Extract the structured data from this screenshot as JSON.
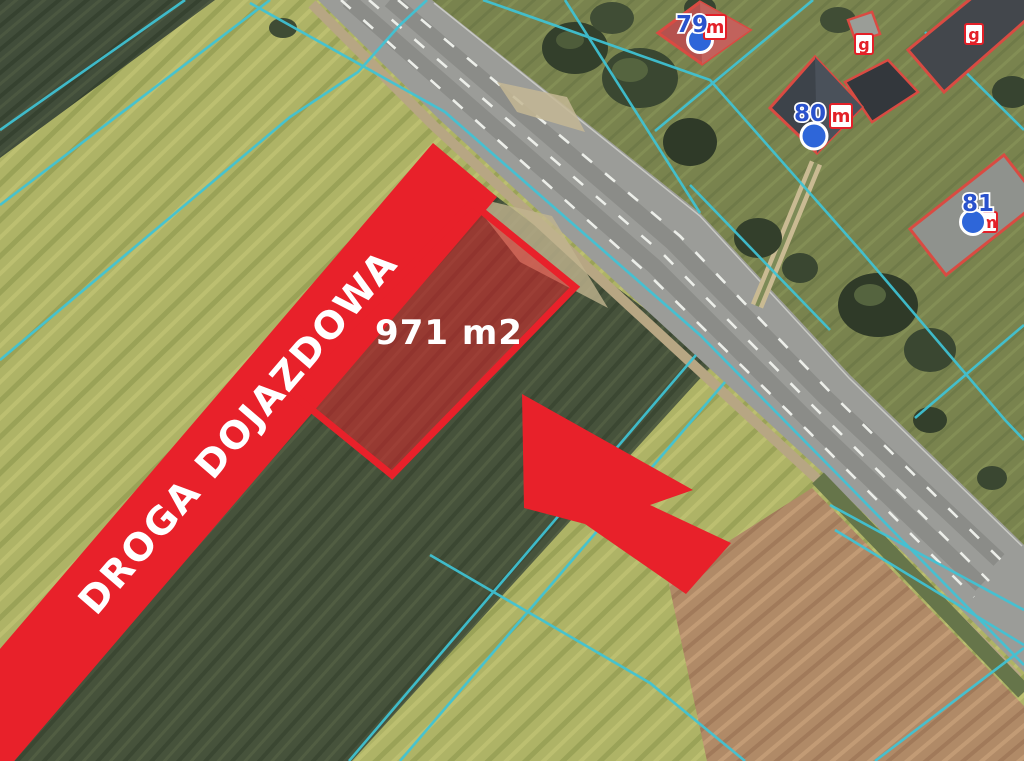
{
  "map": {
    "plot_area_label": "971 m2",
    "access_road_label": "DROGA DOJAZDOWA",
    "plot": {
      "area_m2": 971
    },
    "buildings": [
      {
        "id": "house-79",
        "number": "79",
        "marker": "m"
      },
      {
        "id": "house-80",
        "number": "80",
        "marker": "m"
      },
      {
        "id": "house-81",
        "number": "81",
        "marker": "m"
      },
      {
        "id": "outbuilding-1",
        "marker": "g"
      },
      {
        "id": "outbuilding-2",
        "marker": "g"
      }
    ],
    "colors": {
      "highlight_red": "#e8212a",
      "cadastral_cyan": "#3fc4d6",
      "building_outline_red": "#d94b42",
      "address_number_blue": "#2a52cc",
      "marker_red": "#e32028",
      "address_point_blue": "#2e66d9"
    }
  }
}
